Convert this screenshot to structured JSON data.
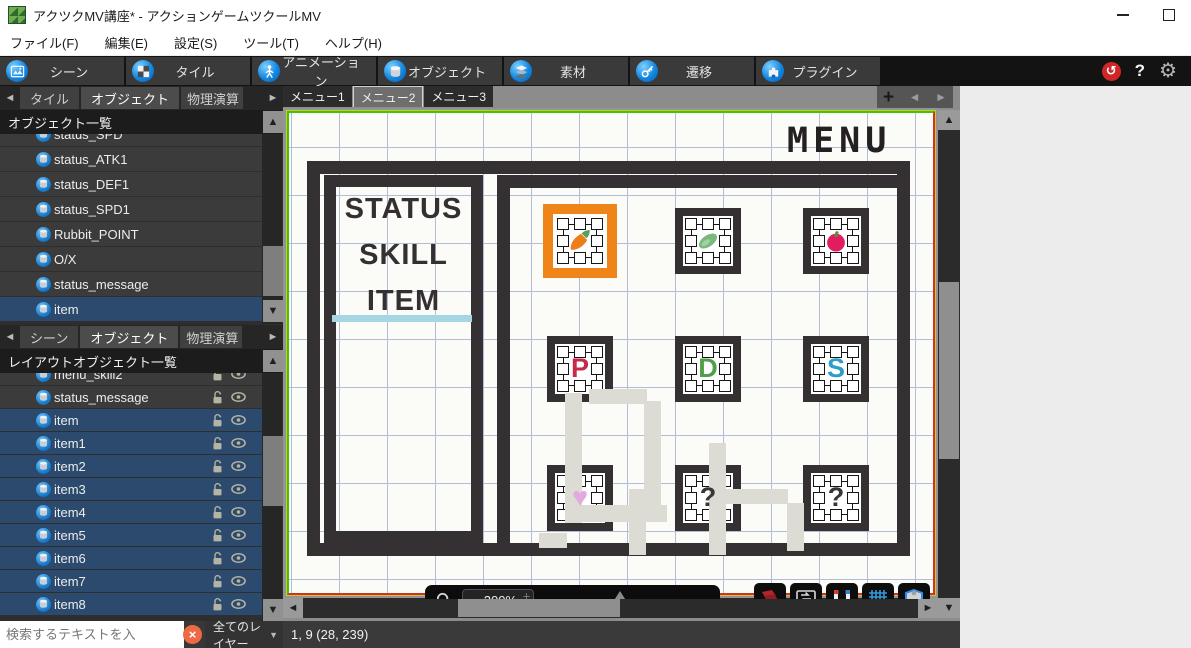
{
  "colors": {
    "selection_blue": "#2b4a6d",
    "selection_orange": "#ef8418",
    "frame_dark": "#353032",
    "grid_blue": "#b3bbd8",
    "underline_blue": "#a5d6e4",
    "undo_red": "#cf2727"
  },
  "window": {
    "title": "アクツクMV講座* - アクションゲームツクールMV"
  },
  "menu_bar": {
    "items": [
      "ファイル(F)",
      "編集(E)",
      "設定(S)",
      "ツール(T)",
      "ヘルプ(H)"
    ]
  },
  "toolbar": {
    "tabs": [
      {
        "label": "シーン",
        "icon": "scene-icon"
      },
      {
        "label": "タイル",
        "icon": "tile-icon"
      },
      {
        "label": "アニメーション",
        "icon": "animation-icon"
      },
      {
        "label": "オブジェクト",
        "icon": "object-icon"
      },
      {
        "label": "素材",
        "icon": "material-icon"
      },
      {
        "label": "遷移",
        "icon": "transition-icon"
      },
      {
        "label": "プラグイン",
        "icon": "plugin-icon"
      }
    ],
    "help_label": "?",
    "undo_glyph": "↺",
    "gear_glyph": "⚙"
  },
  "object_panel": {
    "tabs": [
      {
        "label": "タイル",
        "active": false,
        "clipped": false
      },
      {
        "label": "オブジェクト",
        "active": true,
        "clipped": false
      },
      {
        "label": "物理演算",
        "active": false,
        "clipped": true
      }
    ],
    "header": "オブジェクト一覧",
    "items": [
      {
        "label": "status_SPD",
        "selected": false,
        "clipped": true
      },
      {
        "label": "status_ATK1",
        "selected": false
      },
      {
        "label": "status_DEF1",
        "selected": false
      },
      {
        "label": "status_SPD1",
        "selected": false
      },
      {
        "label": "Rubbit_POINT",
        "selected": false
      },
      {
        "label": "O/X",
        "selected": false
      },
      {
        "label": "status_message",
        "selected": false
      },
      {
        "label": "item",
        "selected": true
      }
    ]
  },
  "layout_panel": {
    "tabs": [
      {
        "label": "シーン",
        "active": false,
        "clipped": false
      },
      {
        "label": "オブジェクト",
        "active": true,
        "clipped": false
      },
      {
        "label": "物理演算",
        "active": false,
        "clipped": true
      }
    ],
    "header": "レイアウトオブジェクト一覧",
    "items": [
      {
        "label": "menu_skill2",
        "selected": false,
        "clipped": true,
        "lock": true,
        "eye": true
      },
      {
        "label": "status_message",
        "selected": false,
        "lock": true,
        "eye": true
      },
      {
        "label": "item",
        "selected": true,
        "lock": true,
        "eye": true
      },
      {
        "label": "item1",
        "selected": true,
        "lock": true,
        "eye": true
      },
      {
        "label": "item2",
        "selected": true,
        "lock": true,
        "eye": true
      },
      {
        "label": "item3",
        "selected": true,
        "lock": true,
        "eye": true
      },
      {
        "label": "item4",
        "selected": true,
        "lock": true,
        "eye": true
      },
      {
        "label": "item5",
        "selected": true,
        "lock": true,
        "eye": true
      },
      {
        "label": "item6",
        "selected": true,
        "lock": true,
        "eye": true
      },
      {
        "label": "item7",
        "selected": true,
        "lock": true,
        "eye": true
      },
      {
        "label": "item8",
        "selected": true,
        "lock": true,
        "eye": true
      }
    ]
  },
  "search_bar": {
    "placeholder": "検索するテキストを入",
    "clear_glyph": "×",
    "layer_filter": "全てのレイヤー"
  },
  "canvas": {
    "tabs": [
      {
        "label": "メニュー1",
        "active": false
      },
      {
        "label": "メニュー2",
        "active": true
      },
      {
        "label": "メニュー3",
        "active": false
      }
    ],
    "scene_title": "MENU",
    "menu_items": [
      "STATUS",
      "SKILL",
      "ITEM"
    ],
    "slots": [
      {
        "name": "slot-carrot",
        "type": "carrot",
        "selected": true
      },
      {
        "name": "slot-leaf",
        "type": "leaf",
        "selected": false
      },
      {
        "name": "slot-apple",
        "type": "apple",
        "selected": false
      },
      {
        "name": "slot-letter-p",
        "type": "glyph",
        "glyph": "P",
        "color": "#c8284c",
        "selected": false
      },
      {
        "name": "slot-letter-d",
        "type": "glyph",
        "glyph": "D",
        "color": "#4f9e49",
        "selected": false
      },
      {
        "name": "slot-letter-s",
        "type": "glyph",
        "glyph": "S",
        "color": "#2b9fc9",
        "selected": false
      },
      {
        "name": "slot-heart",
        "type": "glyph",
        "glyph": "♥",
        "color": "#e2aade",
        "selected": false
      },
      {
        "name": "slot-question-1",
        "type": "glyph",
        "glyph": "?",
        "color": "#3a3637",
        "selected": false
      },
      {
        "name": "slot-question-2",
        "type": "glyph",
        "glyph": "?",
        "color": "#3a3637",
        "selected": false
      }
    ],
    "zoom_control": {
      "value": "200%"
    }
  },
  "status_bar": {
    "text": "1, 9 (28, 239)"
  }
}
